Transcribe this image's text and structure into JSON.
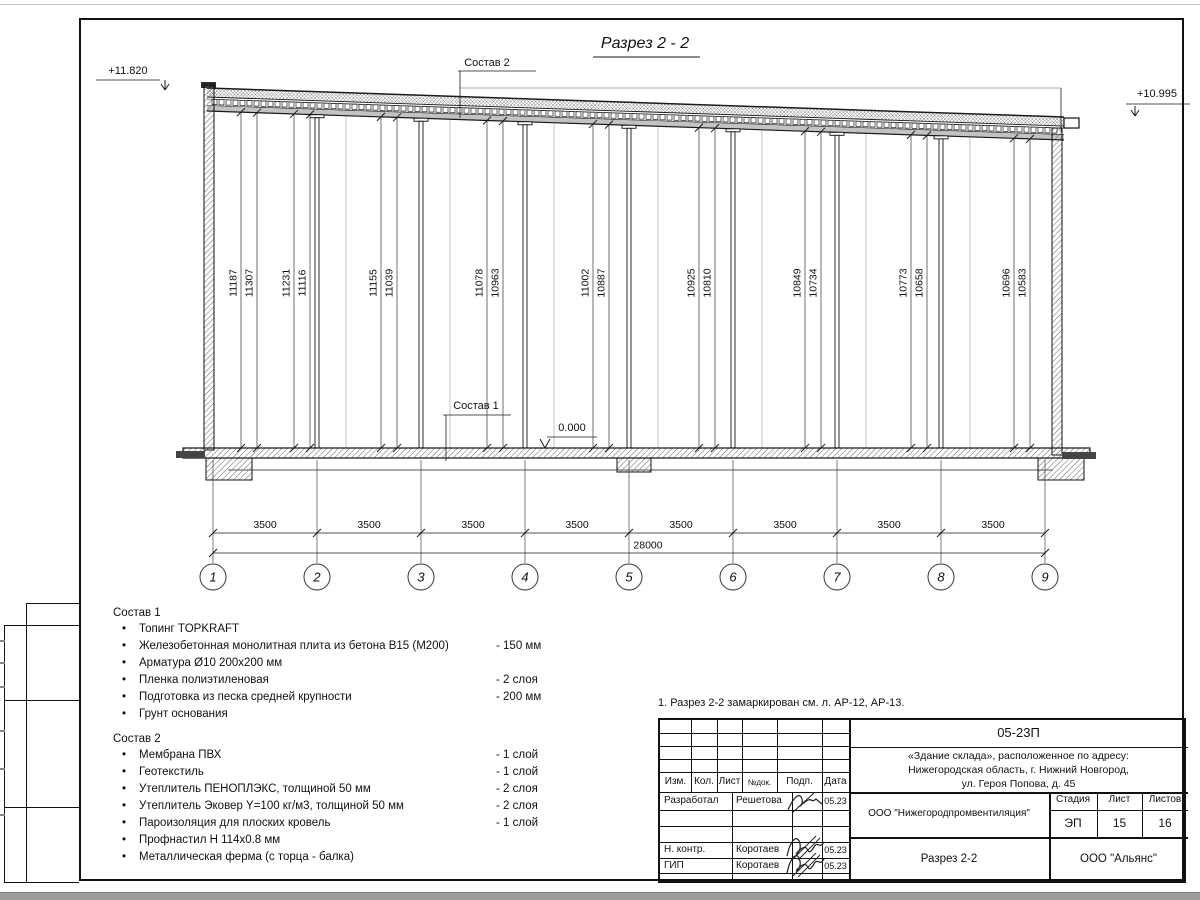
{
  "drawing": {
    "title": "Разрез 2 - 2",
    "elevation_left": "+11.820",
    "elevation_right": "+10.995",
    "zero_level": "0.000",
    "callout_top": "Состав 2",
    "callout_floor": "Состав 1",
    "height_pairs": [
      [
        "11187",
        "11307"
      ],
      [
        "11231",
        "11116"
      ],
      [
        "11155",
        "11039"
      ],
      [
        "11078",
        "10963"
      ],
      [
        "11002",
        "10887"
      ],
      [
        "10925",
        "10810"
      ],
      [
        "10849",
        "10734"
      ],
      [
        "10773",
        "10658"
      ],
      [
        "10696",
        "10583"
      ]
    ],
    "bay_dims": [
      "3500",
      "3500",
      "3500",
      "3500",
      "3500",
      "3500",
      "3500",
      "3500"
    ],
    "total_dim": "28000",
    "axes": [
      "1",
      "2",
      "3",
      "4",
      "5",
      "6",
      "7",
      "8",
      "9"
    ],
    "line_color": "#1a1a1a"
  },
  "sostav1": {
    "heading": "Состав 1",
    "items": [
      {
        "text": "Топинг TOPKRAFT",
        "value": ""
      },
      {
        "text": "Железобетонная монолитная плита из бетона В15 (М200)",
        "value": "-  150 мм"
      },
      {
        "text": "Арматура Ø10 200х200 мм",
        "value": ""
      },
      {
        "text": "Пленка полиэтиленовая",
        "value": "-  2 слоя"
      },
      {
        "text": "Подготовка из песка средней крупности",
        "value": "- 200 мм"
      },
      {
        "text": "Грунт основания",
        "value": ""
      }
    ]
  },
  "sostav2": {
    "heading": "Состав 2",
    "items": [
      {
        "text": "Мембрана ПВХ",
        "value": "- 1 слой"
      },
      {
        "text": "Геотекстиль",
        "value": "- 1 слой"
      },
      {
        "text": "Утеплитель ПЕНОПЛЭКС, толщиной 50 мм",
        "value": "- 2 слоя"
      },
      {
        "text": "Утеплитель Эковер Y=100 кг/м3, толщиной 50 мм",
        "value": "- 2 слоя"
      },
      {
        "text": "Пароизоляция для плоских кровель",
        "value": "- 1 слой"
      },
      {
        "text": "Профнастил Н 114х0.8 мм",
        "value": ""
      },
      {
        "text": "Металлическая ферма (с торца - балка)",
        "value": ""
      }
    ]
  },
  "note": "1. Разрез 2-2 замаркирован см. л. АР-12, АР-13.",
  "titleblock": {
    "code": "05-23П",
    "object": [
      "«Здание склада», расположенное по адресу:",
      "Нижегородская область, г. Нижний Новгород,",
      "ул. Героя Попова, д. 45"
    ],
    "org": "ООО \"Нижегородпромвентиляция\"",
    "doc_title": "Разрез 2-2",
    "company": "ООО \"Альянс\"",
    "stage_label": "Стадия",
    "sheet_label": "Лист",
    "sheets_label": "Листов",
    "stage": "ЭП",
    "sheet": "15",
    "sheets": "16",
    "cols": [
      "Изм.",
      "Кол.",
      "Лист",
      "№док.",
      "Подп.",
      "Дата"
    ],
    "rows": [
      {
        "role": "Разработал",
        "name": "Решетова",
        "date": "05.23"
      },
      {
        "role": "Н. контр.",
        "name": "Коротаев",
        "date": "05.23"
      },
      {
        "role": "ГИП",
        "name": "Коротаев",
        "date": "05.23"
      }
    ]
  }
}
